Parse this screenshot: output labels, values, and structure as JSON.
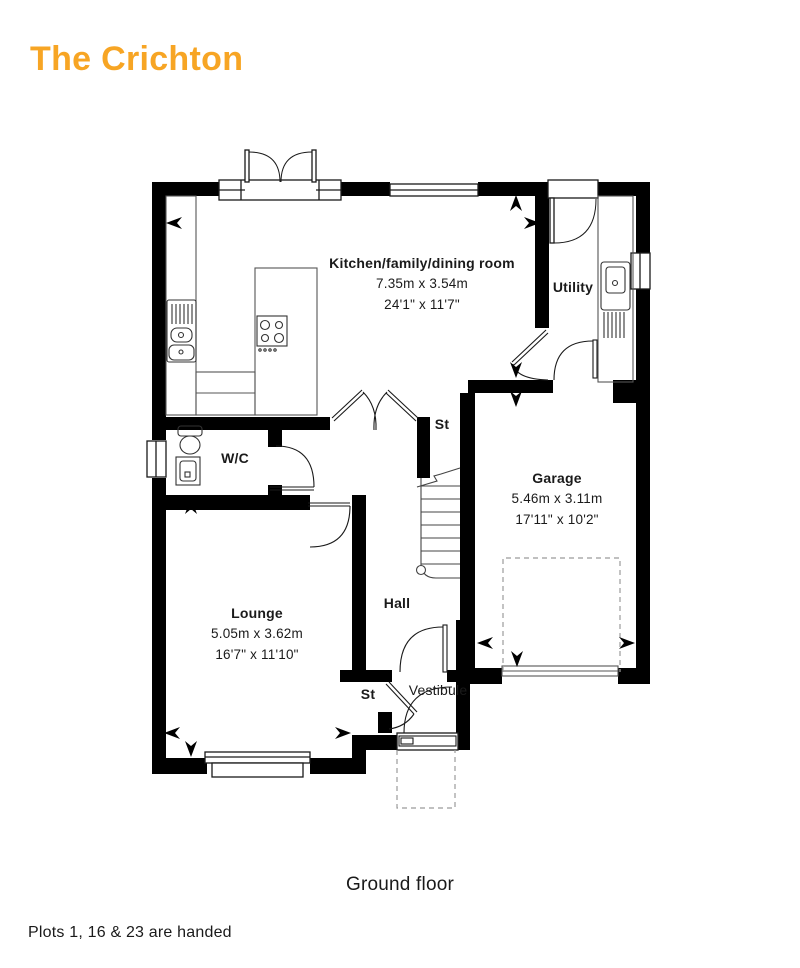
{
  "page": {
    "title": "The Crichton",
    "floor_caption": "Ground floor",
    "footnote": "Plots 1, 16 & 23 are handed"
  },
  "rooms": {
    "kitchen": {
      "name": "Kitchen/family/dining room",
      "metric": "7.35m x 3.54m",
      "imperial": "24'1\" x 11'7\""
    },
    "utility": {
      "name": "Utility"
    },
    "store_upper": {
      "name": "St"
    },
    "garage": {
      "name": "Garage",
      "metric": "5.46m x 3.11m",
      "imperial": "17'11\" x 10'2\""
    },
    "wc": {
      "name": "W/C"
    },
    "lounge": {
      "name": "Lounge",
      "metric": "5.05m x 3.62m",
      "imperial": "16'7\" x 11'10\""
    },
    "hall": {
      "name": "Hall"
    },
    "store_lower": {
      "name": "St"
    },
    "vestibule": {
      "name": "Vestibule"
    }
  },
  "colors": {
    "accent_orange": "#F7A524",
    "wall_black": "#000000",
    "text_dark": "#1A1A1A",
    "dashed_grey": "#9B9B9B"
  }
}
